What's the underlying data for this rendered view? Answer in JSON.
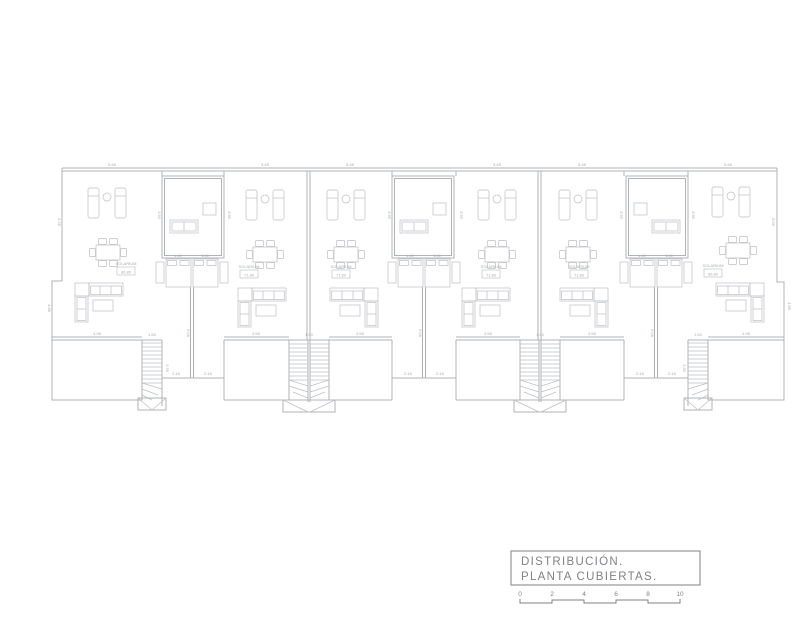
{
  "colors": {
    "line": "#b0b3b6",
    "furn": "#bcbfc2",
    "dim": "#a8abae",
    "text": "#7f8285"
  },
  "units": [
    {
      "id": "unit-1",
      "label": "SOLARIUM",
      "area": "86.80"
    },
    {
      "id": "unit-2",
      "label": "SOLARIUM",
      "area": "71.80"
    },
    {
      "id": "unit-3",
      "label": "SOLARIUM",
      "area": "71.80"
    },
    {
      "id": "unit-4",
      "label": "SOLARIUM",
      "area": "71.80"
    },
    {
      "id": "unit-5",
      "label": "SOLARIUM",
      "area": "71.80"
    },
    {
      "id": "unit-6",
      "label": "SOLARIUM",
      "area": "86.80"
    }
  ],
  "title_block": {
    "line1": "DISTRIBUCIÓN.",
    "line2": "PLANTA CUBIERTAS.",
    "scale_ticks": [
      "0",
      "2",
      "4",
      "6",
      "8",
      "10"
    ]
  },
  "dim_marks": [
    {
      "v": "5.48",
      "x": 112,
      "y": 166,
      "r": 0
    },
    {
      "v": "5.48",
      "x": 265,
      "y": 166,
      "r": 0
    },
    {
      "v": "5.48",
      "x": 350,
      "y": 166,
      "r": 0
    },
    {
      "v": "5.48",
      "x": 497,
      "y": 166,
      "r": 0
    },
    {
      "v": "5.48",
      "x": 582,
      "y": 166,
      "r": 0
    },
    {
      "v": "5.48",
      "x": 728,
      "y": 166,
      "r": 0
    },
    {
      "v": "1.40",
      "x": 178,
      "y": 257,
      "r": 0
    },
    {
      "v": "1.40",
      "x": 205,
      "y": 257,
      "r": 0
    },
    {
      "v": "1.40",
      "x": 410,
      "y": 257,
      "r": 0
    },
    {
      "v": "1.40",
      "x": 437,
      "y": 257,
      "r": 0
    },
    {
      "v": "1.40",
      "x": 642,
      "y": 257,
      "r": 0
    },
    {
      "v": "1.40",
      "x": 669,
      "y": 257,
      "r": 0
    },
    {
      "v": "2.15",
      "x": 176,
      "y": 375,
      "r": 0
    },
    {
      "v": "2.15",
      "x": 208,
      "y": 375,
      "r": 0
    },
    {
      "v": "2.15",
      "x": 408,
      "y": 375,
      "r": 0
    },
    {
      "v": "2.15",
      "x": 440,
      "y": 375,
      "r": 0
    },
    {
      "v": "2.15",
      "x": 640,
      "y": 375,
      "r": 0
    },
    {
      "v": "2.15",
      "x": 672,
      "y": 375,
      "r": 0
    },
    {
      "v": "3.58",
      "x": 256,
      "y": 335,
      "r": 0
    },
    {
      "v": "3.58",
      "x": 360,
      "y": 335,
      "r": 0
    },
    {
      "v": "3.58",
      "x": 488,
      "y": 335,
      "r": 0
    },
    {
      "v": "3.58",
      "x": 592,
      "y": 335,
      "r": 0
    },
    {
      "v": "4.98",
      "x": 97,
      "y": 335,
      "r": 0
    },
    {
      "v": "4.98",
      "x": 746,
      "y": 335,
      "r": 0
    },
    {
      "v": "1.50",
      "x": 152,
      "y": 336,
      "r": 0
    },
    {
      "v": "1.50",
      "x": 309,
      "y": 336,
      "r": 0
    },
    {
      "v": "1.50",
      "x": 540,
      "y": 336,
      "r": 0
    },
    {
      "v": "1.50",
      "x": 698,
      "y": 336,
      "r": 0
    },
    {
      "v": "5.08",
      "x": 187,
      "y": 333,
      "r": 90
    },
    {
      "v": "5.08",
      "x": 419,
      "y": 333,
      "r": 90
    },
    {
      "v": "5.08",
      "x": 651,
      "y": 333,
      "r": 90
    },
    {
      "v": "3.36",
      "x": 58,
      "y": 222,
      "r": 90
    },
    {
      "v": "5.05",
      "x": 772,
      "y": 222,
      "r": 90
    },
    {
      "v": "4.88",
      "x": 48,
      "y": 308,
      "r": 90
    },
    {
      "v": "4.88",
      "x": 788,
      "y": 306,
      "r": 90
    },
    {
      "v": "3.35",
      "x": 166,
      "y": 368,
      "r": 90
    },
    {
      "v": "3.35",
      "x": 683,
      "y": 368,
      "r": 90
    },
    {
      "v": "3.95",
      "x": 158,
      "y": 215,
      "r": 90
    },
    {
      "v": "3.95",
      "x": 228,
      "y": 215,
      "r": 90
    },
    {
      "v": "3.95",
      "x": 388,
      "y": 215,
      "r": 90
    },
    {
      "v": "3.95",
      "x": 460,
      "y": 215,
      "r": 90
    },
    {
      "v": "3.95",
      "x": 620,
      "y": 215,
      "r": 90
    },
    {
      "v": "3.95",
      "x": 692,
      "y": 215,
      "r": 90
    }
  ]
}
